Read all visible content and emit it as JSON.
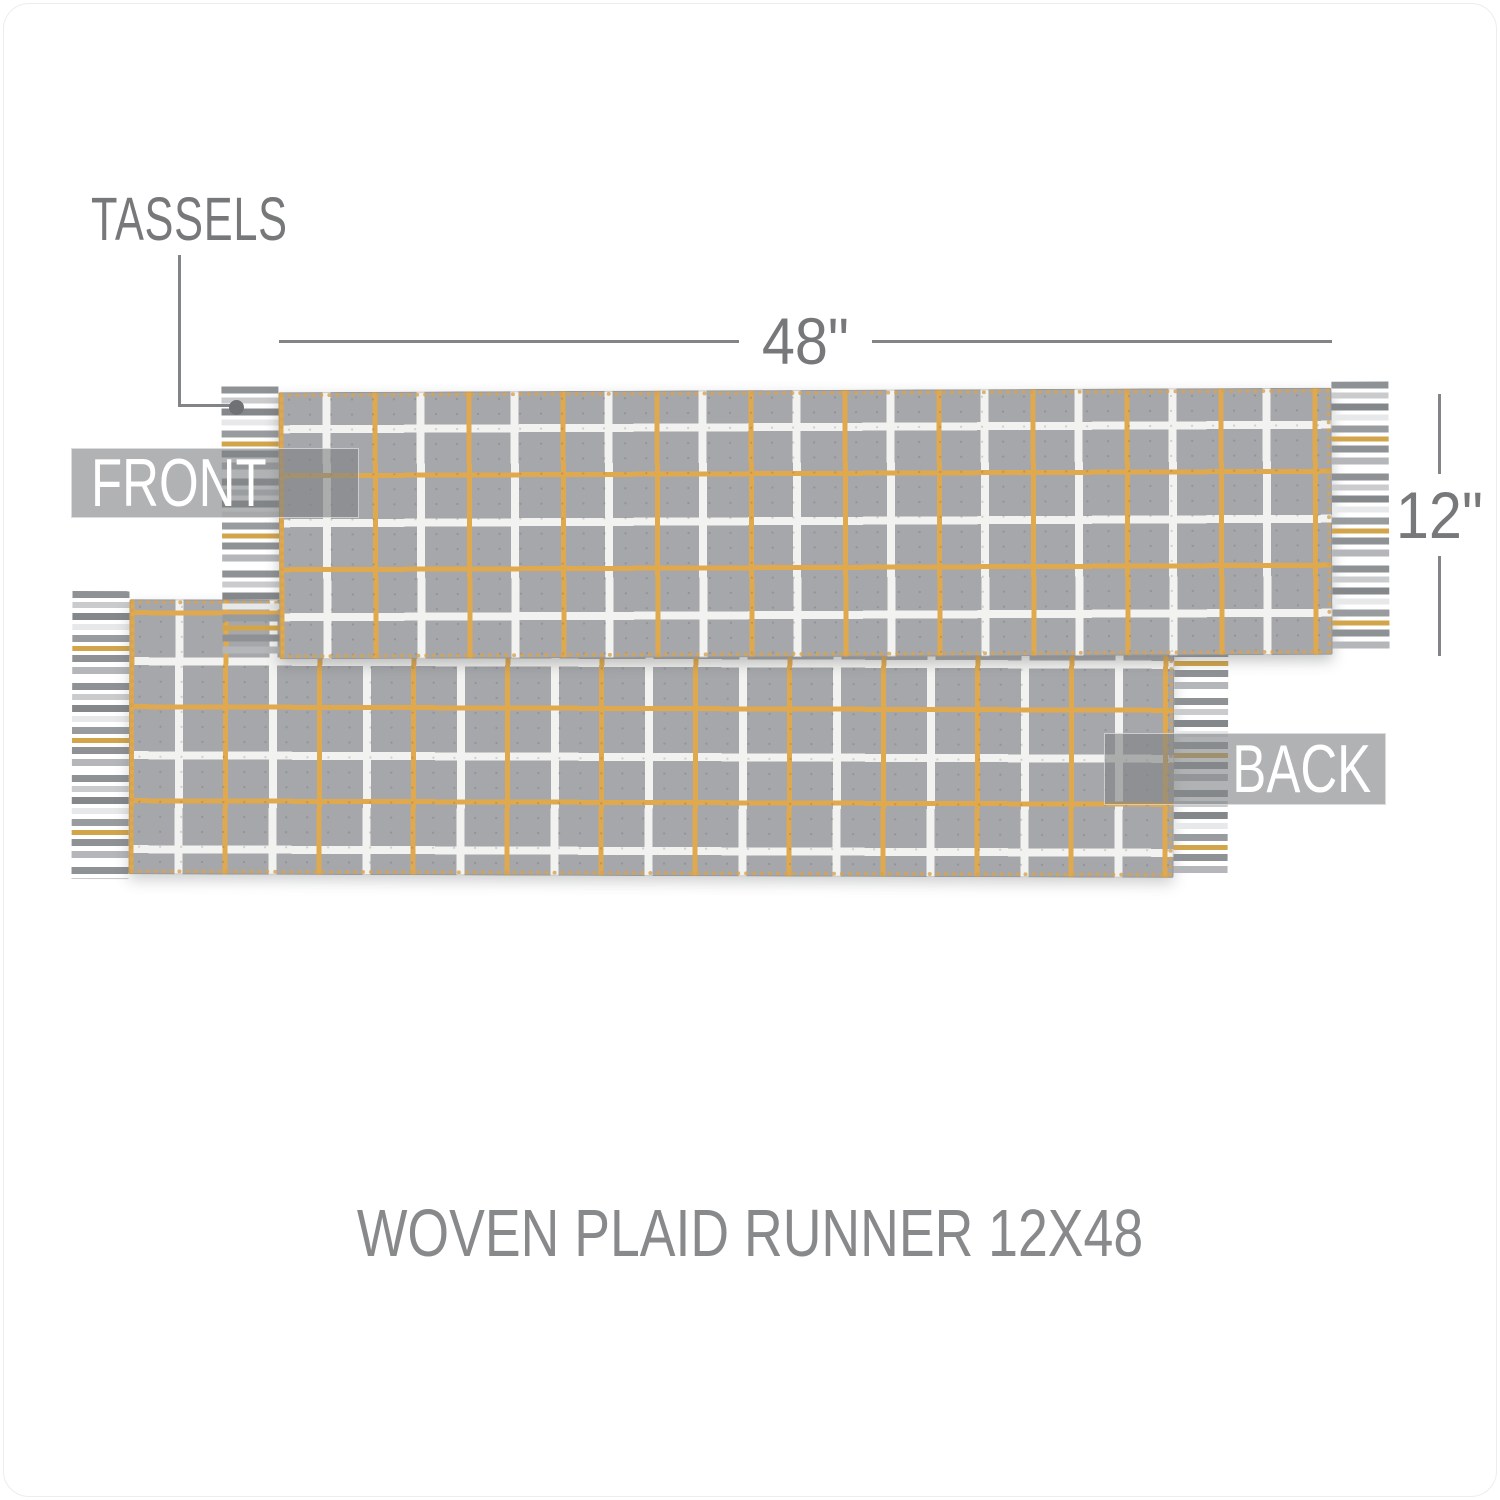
{
  "title": "WOVEN PLAID RUNNER 12X48",
  "annotations": {
    "tassels_label": "TASSELS",
    "width_label": "48\"",
    "height_label": "12\"",
    "front_label": "FRONT",
    "back_label": "BACK"
  },
  "product": {
    "views_shown": [
      "FRONT",
      "BACK"
    ],
    "width_inches": 48,
    "height_inches": 12,
    "feature_callout": "tassels on both ends",
    "pattern": "gray windowpane plaid with white and gold lines"
  },
  "colors": {
    "fabric-gray": "#a5a7aa",
    "plaid-white": "#f2f2f0",
    "plaid-gold": "#e0a94e",
    "hem-gold": "#d8a452",
    "dim-gray": "#828487",
    "text-gray": "#77787a",
    "title-gray": "#87898b",
    "label-bg": "rgba(128,130,132,0.62)",
    "label-text": "#ffffff",
    "page-bg": "#ffffff"
  }
}
